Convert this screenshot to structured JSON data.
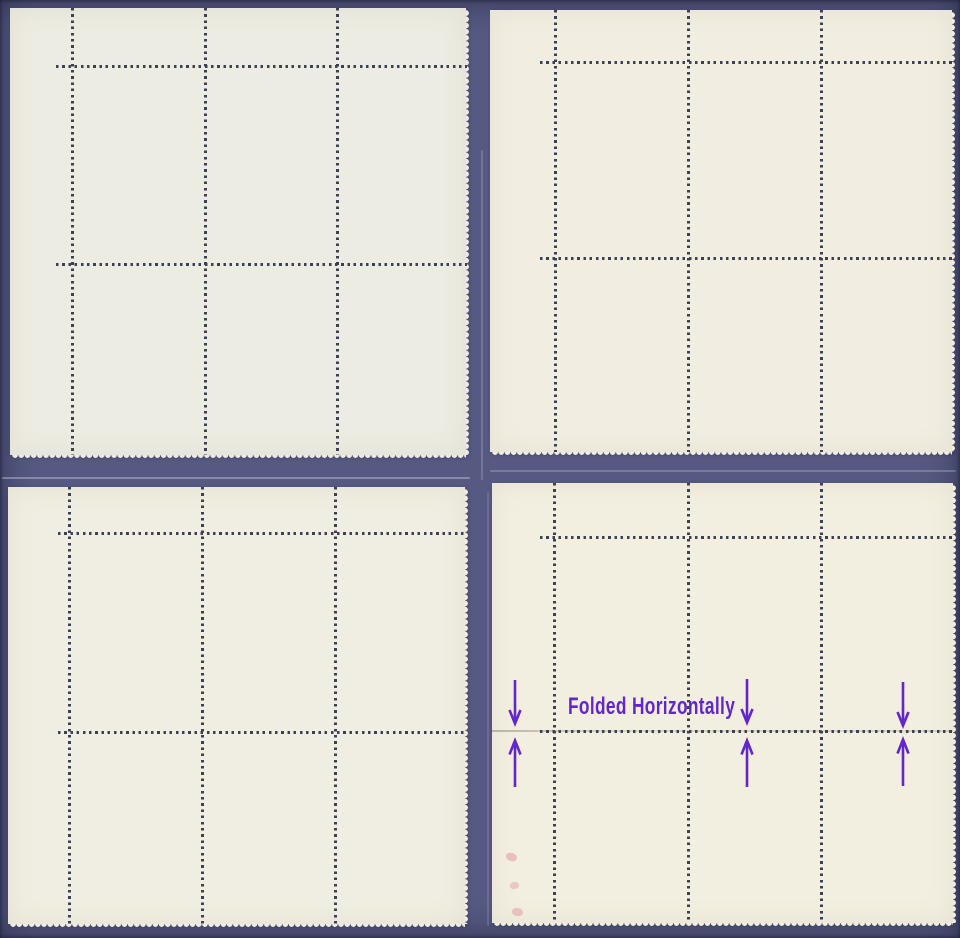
{
  "scene": {
    "type": "photo of four mint stamp blocks shown gum-side (back), mounted on a dark blue stock page",
    "background_color": "#565a82",
    "perforation_dot_color": "#3b4053"
  },
  "sheets": [
    {
      "id": "top-left",
      "paper_color": "#edece2",
      "stamp_columns": 3,
      "stamp_rows": 2,
      "perforated_edges": "right and bottom",
      "straight_edges": "top and left"
    },
    {
      "id": "top-right",
      "paper_color": "#f1eee1",
      "stamp_columns": 3,
      "stamp_rows": 2,
      "perforated_edges": "right and bottom",
      "straight_edges": "top and left"
    },
    {
      "id": "bottom-left",
      "paper_color": "#f0eee2",
      "stamp_columns": 3,
      "stamp_rows": 2,
      "perforated_edges": "right and bottom",
      "straight_edges": "top and left"
    },
    {
      "id": "bottom-right",
      "paper_color": "#f3efe0",
      "stamp_columns": 3,
      "stamp_rows": 2,
      "perforated_edges": "right and bottom",
      "straight_edges": "top and left",
      "visible_flaws": "horizontal fold crease along middle perforation row; faint red marks in left selvage"
    }
  ],
  "annotation": {
    "label": "Folded Horizontally",
    "color": "#6227cc",
    "arrow_pairs": 3,
    "arrow_icons": [
      "down-arrow",
      "up-arrow"
    ]
  }
}
